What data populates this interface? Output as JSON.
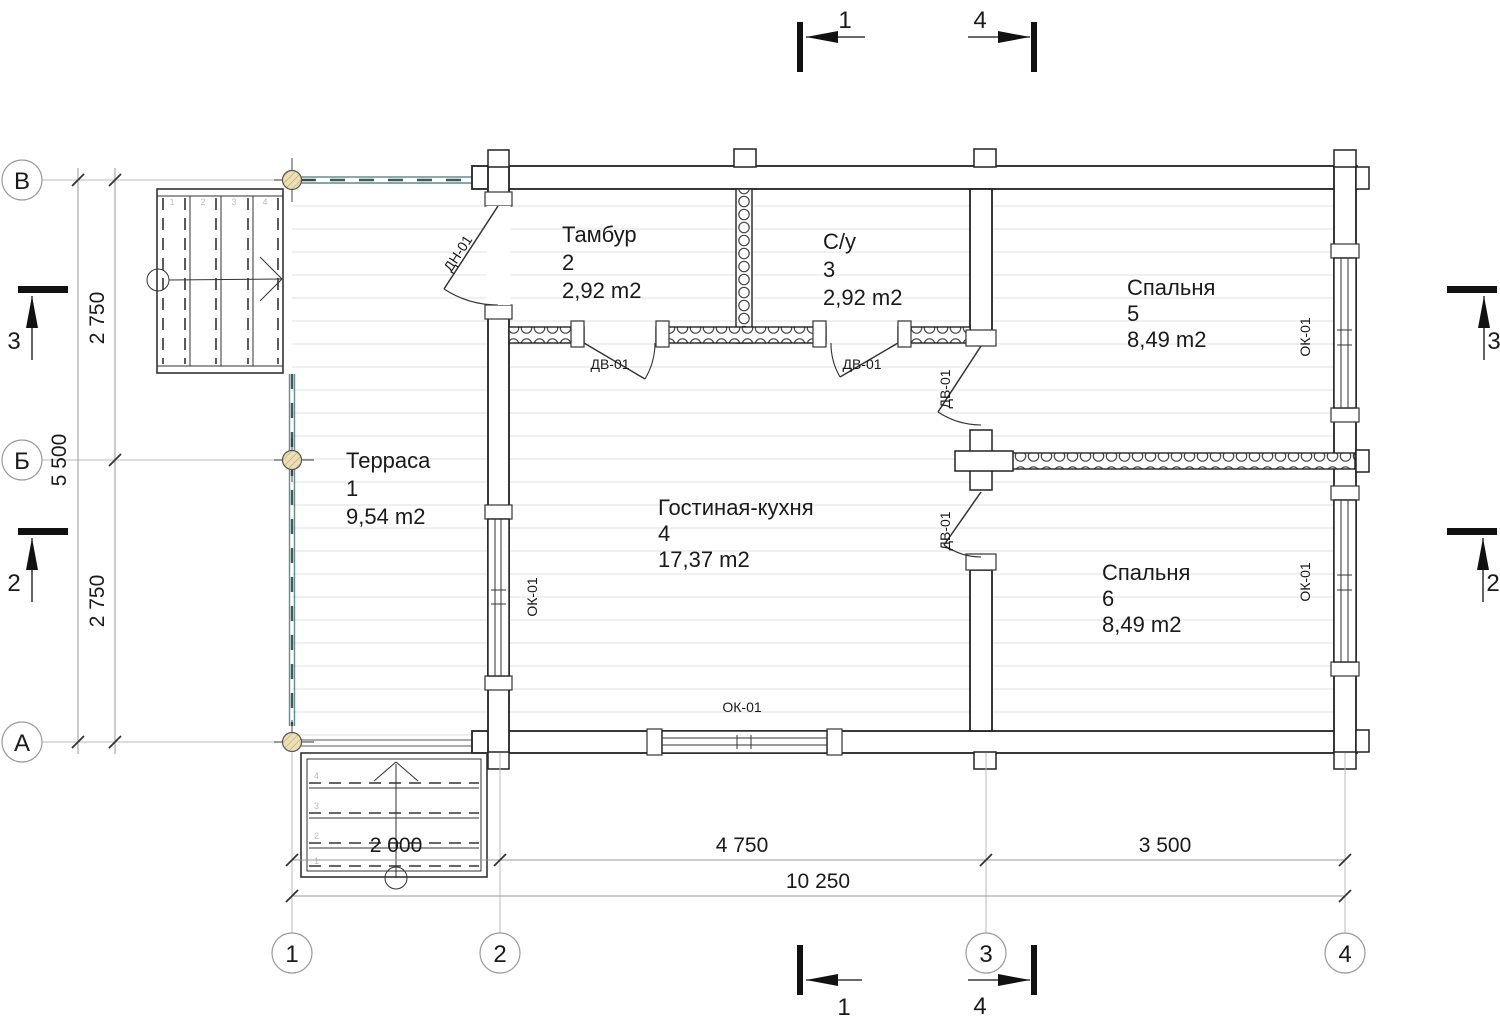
{
  "rooms": [
    {
      "name": "Терраса",
      "number": "1",
      "area": "9,54 m2"
    },
    {
      "name": "Тамбур",
      "number": "2",
      "area": "2,92 m2"
    },
    {
      "name": "С/у",
      "number": "3",
      "area": "2,92 m2"
    },
    {
      "name": "Гостиная-кухня",
      "number": "4",
      "area": "17,37 m2"
    },
    {
      "name": "Спальня",
      "number": "5",
      "area": "8,49 m2"
    },
    {
      "name": "Спальня",
      "number": "6",
      "area": "8,49 m2"
    }
  ],
  "axes": {
    "v": [
      "1",
      "2",
      "3",
      "4"
    ],
    "h": [
      "В",
      "Б",
      "А"
    ]
  },
  "dims": {
    "bottom": [
      "2 000",
      "4 750",
      "3 500",
      "10 250"
    ],
    "left": [
      "2 750",
      "5 500",
      "2 750"
    ]
  },
  "sections": {
    "one": "1",
    "two": "2",
    "three": "3",
    "four": "4"
  },
  "tags": {
    "entry_door": "ДН-01",
    "door": "ДВ-01",
    "window": "ОК-01"
  },
  "stairs": {
    "upper_steps": [
      "1",
      "2",
      "3",
      "4"
    ],
    "lower_steps": [
      "1",
      "2",
      "3",
      "4"
    ]
  },
  "colors": {
    "line": "#222222",
    "dim_line": "#999999",
    "floor_line": "#ebebeb",
    "railing": "#5f8f8f",
    "column_fill": "#ecdfb4"
  }
}
